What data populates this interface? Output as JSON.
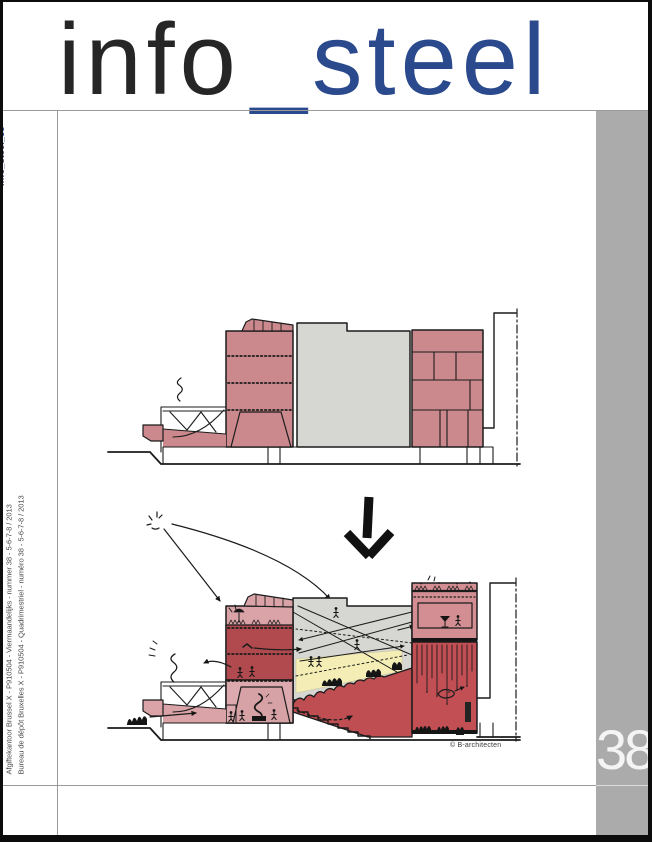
{
  "masthead": {
    "word_black": "info",
    "word_blue": "_steel"
  },
  "spine": {
    "issue_tag_prefix": "info_steel",
    "issue_tag_suffix": "_38",
    "postal_line_nl": "Afgiftekantoor Brussel X - P910504 - Viermaandelijks - nummer 38 - 5-6-7-8 / 2013",
    "postal_line_fr": "Bureau de dépôt Bruxelles X - P910504 - Quadrimestriel - numéro 38 - 5-6-7-8 / 2013"
  },
  "page_number": "38",
  "figure": {
    "credit": "© B-architecten",
    "icons": [
      "down-arrow-icon",
      "sun-icon",
      "smoke-icon",
      "fish-icon",
      "bird-icon",
      "crowd-icon",
      "umbrella-icon",
      "martini-icon"
    ]
  },
  "colors": {
    "accent_blue": "#2a4a8d",
    "masthead_black": "#262626",
    "strip_gray": "#ababab",
    "hairline_gray": "#9b9b9b",
    "drawing_pink": "#cb898d",
    "drawing_gray": "#d6d6d3",
    "dark_red": "#b04a4f",
    "hall_red": "#c14f54",
    "light_pink": "#dcaaae",
    "pale_yellow": "#f4eeb6"
  }
}
